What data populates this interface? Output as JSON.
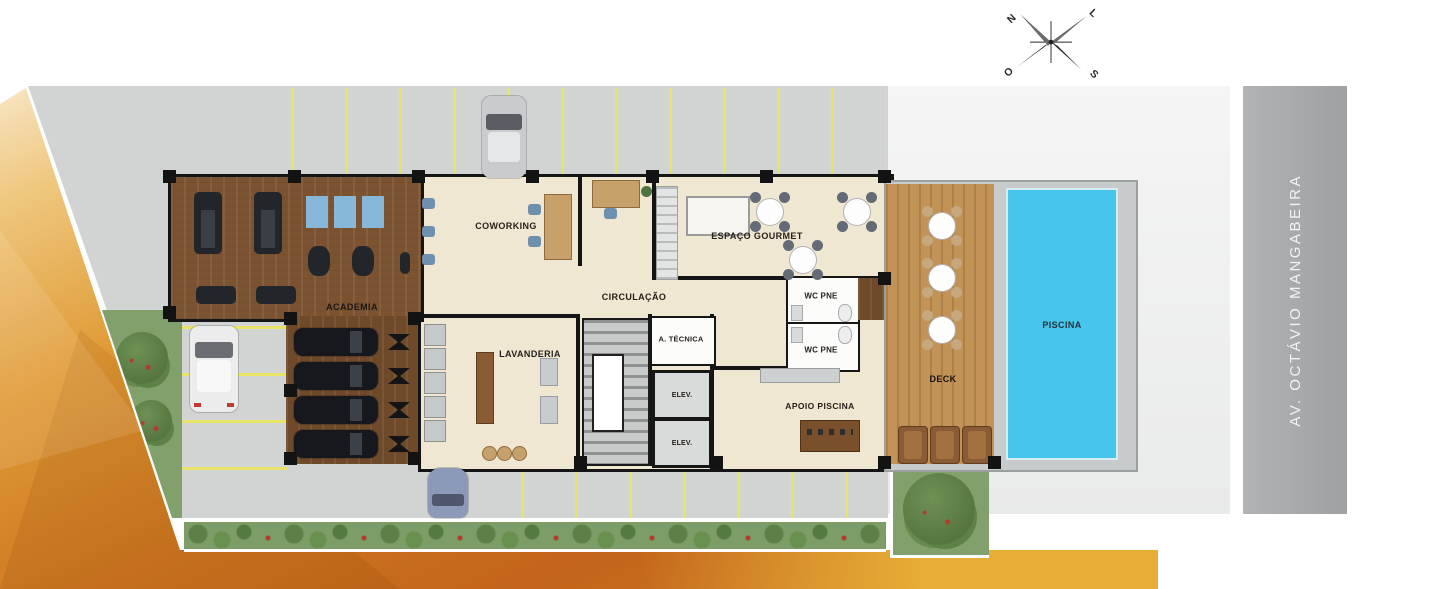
{
  "scene": "ground-floor-plan",
  "compass": {
    "north": "N",
    "east": "L",
    "west": "O",
    "south": "S"
  },
  "street": {
    "name": "AV. OCTÁVIO MANGABEIRA"
  },
  "rooms": {
    "academia": "ACADEMIA",
    "coworking": "COWORKING",
    "circulacao": "CIRCULAÇÃO",
    "espaco_gourmet": "ESPAÇO GOURMET",
    "lavanderia": "LAVANDERIA",
    "area_tecnica": "A. TÉCNICA",
    "elevador": "ELEV.",
    "wc_pne": "WC PNE",
    "apoio_piscina": "APOIO PISCINA",
    "deck": "DECK",
    "piscina": "PISCINA"
  },
  "colors": {
    "orange_deep": "#c2641b",
    "orange_light": "#f9efdb",
    "gold_band": "#e7ad36",
    "pavement": "#d2d4d4",
    "avenue_gray": "#a4a8a8",
    "gym_wood": "#7b5330",
    "deck_wood": "#c19357",
    "floor_beige": "#f0e7d3",
    "pool_blue": "#47c5ec",
    "garden_green": "#82a06c",
    "stall_yellow": "#e8e468"
  }
}
